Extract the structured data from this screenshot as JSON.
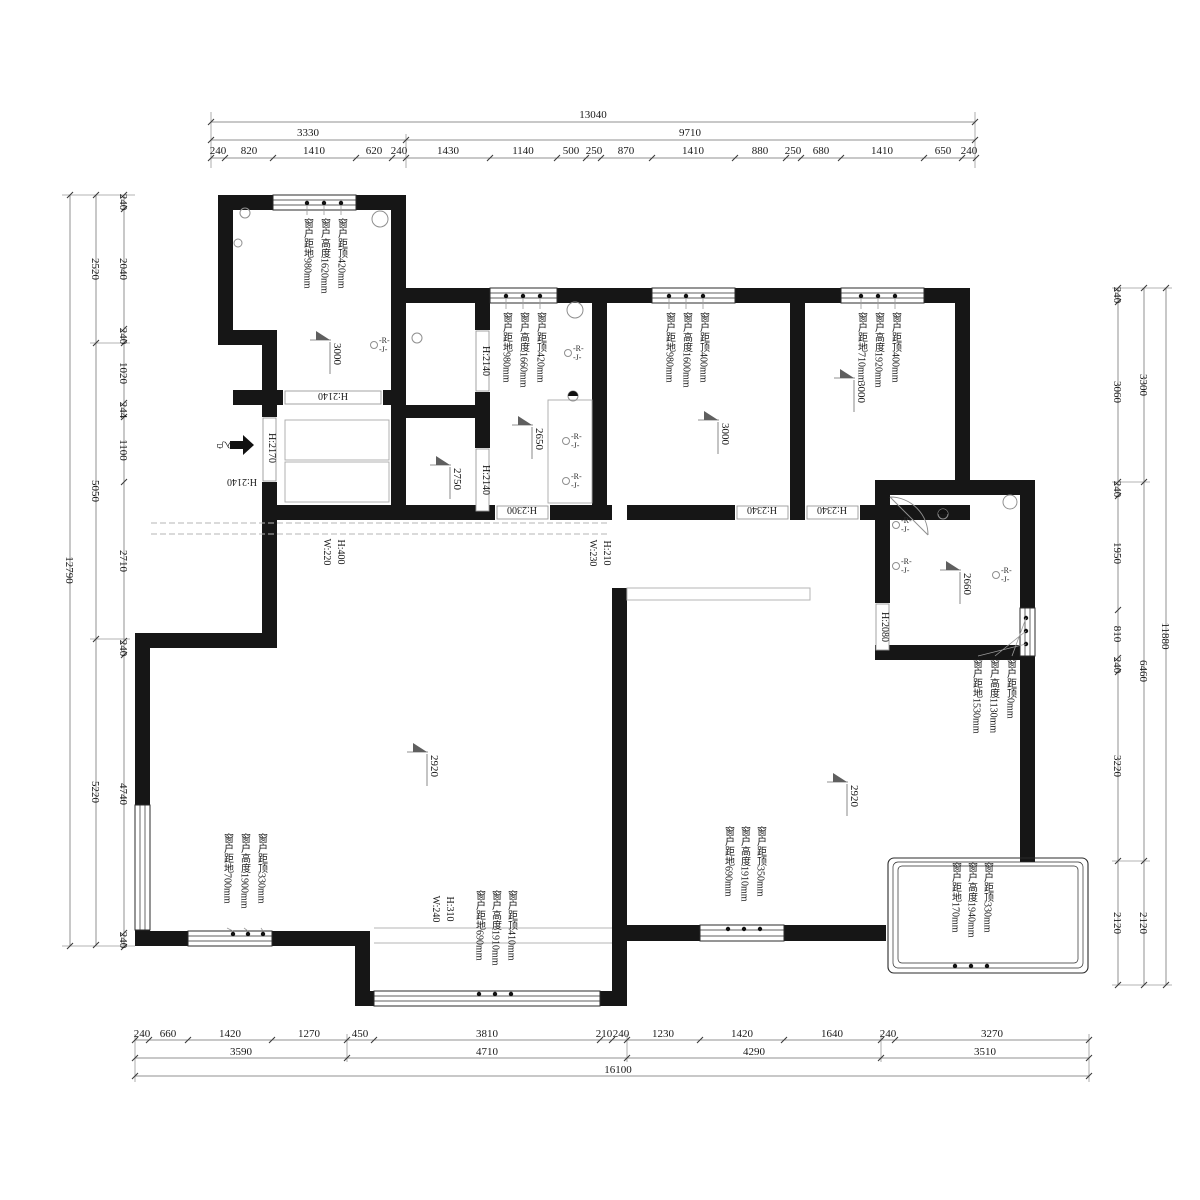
{
  "dims": {
    "top": {
      "total": "13040",
      "groups": [
        "3330",
        "9710"
      ],
      "detail": [
        "240",
        "820",
        "1410",
        "620",
        "240",
        "1430",
        "1140",
        "500",
        "250",
        "870",
        "1410",
        "880",
        "250",
        "680",
        "1410",
        "650",
        "240"
      ]
    },
    "left": {
      "total": "12790",
      "groups": [
        "2520",
        "5050",
        "5220"
      ],
      "detail": [
        "240",
        "2040",
        "240",
        "1020",
        "244",
        "1100",
        "2710",
        "240",
        "4740",
        "240"
      ]
    },
    "right": {
      "total": "11880",
      "groups": [
        "3300",
        "6460",
        "2120"
      ],
      "detail": [
        "240",
        "3060",
        "240",
        "1950",
        "810",
        "240",
        "3220",
        "2120"
      ]
    },
    "bottom": {
      "total": "16100",
      "groups": [
        "3590",
        "4710",
        "4290",
        "3510"
      ],
      "detail": [
        "240",
        "660",
        "1420",
        "1270",
        "450",
        "3810",
        "210",
        "240",
        "1230",
        "1420",
        "1640",
        "240",
        "3270"
      ]
    }
  },
  "windows": {
    "w1": {
      "lines": [
        "窗户距顶420mm",
        "窗户高度1620mm",
        "窗户距地980mm"
      ]
    },
    "w2": {
      "lines": [
        "窗户距顶420mm",
        "窗户高度1660mm",
        "窗户距地980mm"
      ]
    },
    "w3": {
      "lines": [
        "窗户距顶400mm",
        "窗户高度1600mm",
        "窗户距地980mm"
      ]
    },
    "w4": {
      "lines": [
        "窗户距顶400mm",
        "窗户高度1920mm",
        "窗户距地710mm"
      ]
    },
    "w5": {
      "lines": [
        "窗户距顶0mm",
        "窗户高度1130mm",
        "窗户距地1530mm"
      ]
    },
    "w6": {
      "lines": [
        "窗户距顶330mm",
        "窗户高度1900mm",
        "窗户距地700mm"
      ]
    },
    "w7": {
      "lines": [
        "窗户距顶410mm",
        "窗户高度1910mm",
        "窗户距地690mm"
      ]
    },
    "w8": {
      "lines": [
        "窗户距顶350mm",
        "窗户高度1910mm",
        "窗户距地690mm"
      ]
    },
    "w9": {
      "lines": [
        "窗户距顶330mm",
        "窗户高度1940mm",
        "窗户距地170mm"
      ]
    }
  },
  "doors": {
    "entry": "H:2170",
    "hall": "H:2140",
    "tl": "H:2140",
    "small1": "H:2140",
    "small2": "H:2140",
    "kitchen": "H:2300",
    "bed_mid": "H:2340",
    "bed_right": "H:2340",
    "bath": "H:2080"
  },
  "beams": {
    "b1": {
      "h": "H:400",
      "w": "W:220"
    },
    "b2": {
      "h": "H:210",
      "w": "W:230"
    },
    "b3": {
      "h": "H:310",
      "w": "W:240"
    }
  },
  "elevations": {
    "bed_tl": "3000",
    "kitchen": "2650",
    "store": "2750",
    "bed_mid": "3000",
    "bed_right": "3000",
    "bath": "2660",
    "living": "2920",
    "dining": "2920"
  },
  "symbols": {
    "rj_r": "-R-",
    "rj_j": "-J-",
    "entry": "入户"
  },
  "colors": {
    "wall": "#161616",
    "dim_line": "#909090",
    "text": "#1a1a1a",
    "beam": "#b5b5b5"
  }
}
